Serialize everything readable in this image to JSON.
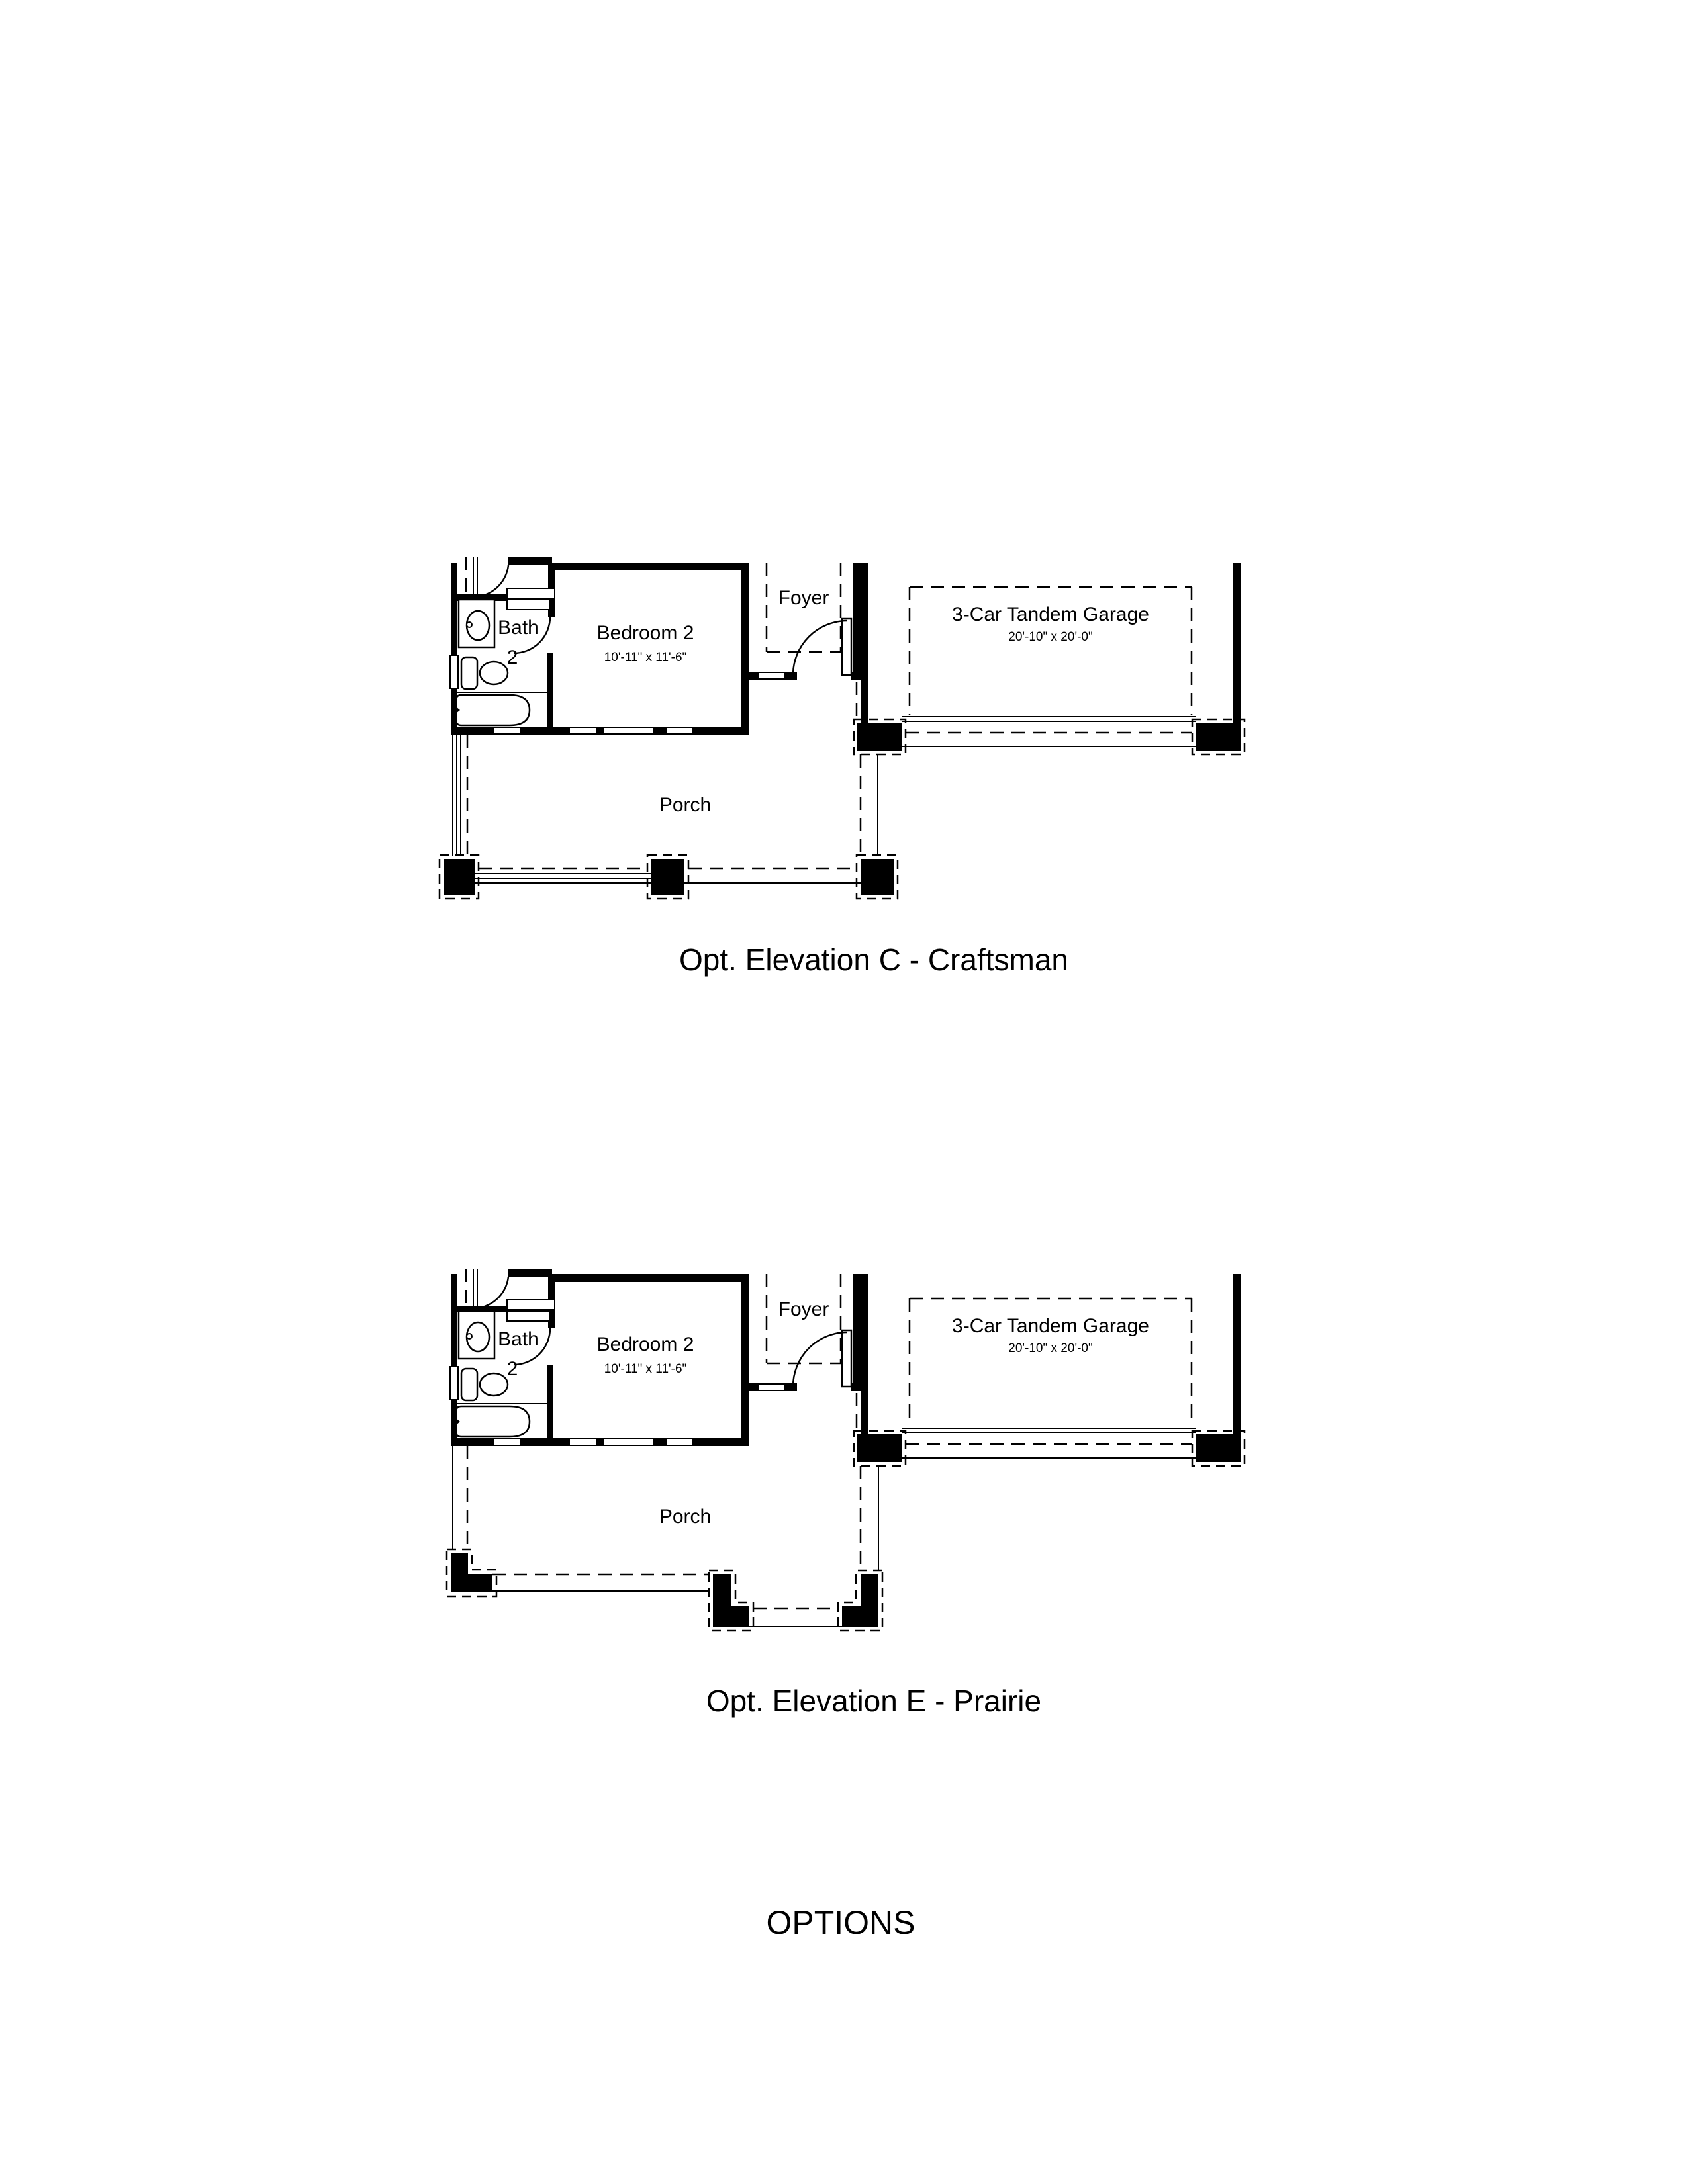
{
  "document": {
    "kind": "floor-plan-options-sheet",
    "background_color": "#ffffff",
    "ink_color": "#000000"
  },
  "plans": [
    {
      "id": "elevation-c",
      "caption": "Opt. Elevation C - Craftsman",
      "porch_style": "square-columns",
      "labels": {
        "bath_line1": "Bath",
        "bath_line2": "2",
        "bedroom": "Bedroom 2",
        "bedroom_dims": "10'-11\" x 11'-6\"",
        "foyer": "Foyer",
        "garage": "3-Car Tandem Garage",
        "garage_dims": "20'-10\" x 20'-0\"",
        "porch": "Porch"
      }
    },
    {
      "id": "elevation-e",
      "caption": "Opt. Elevation E - Prairie",
      "porch_style": "corner-l-columns",
      "labels": {
        "bath_line1": "Bath",
        "bath_line2": "2",
        "bedroom": "Bedroom 2",
        "bedroom_dims": "10'-11\" x 11'-6\"",
        "foyer": "Foyer",
        "garage": "3-Car Tandem Garage",
        "garage_dims": "20'-10\" x 20'-0\"",
        "porch": "Porch"
      }
    }
  ],
  "footer": {
    "title": "OPTIONS"
  }
}
